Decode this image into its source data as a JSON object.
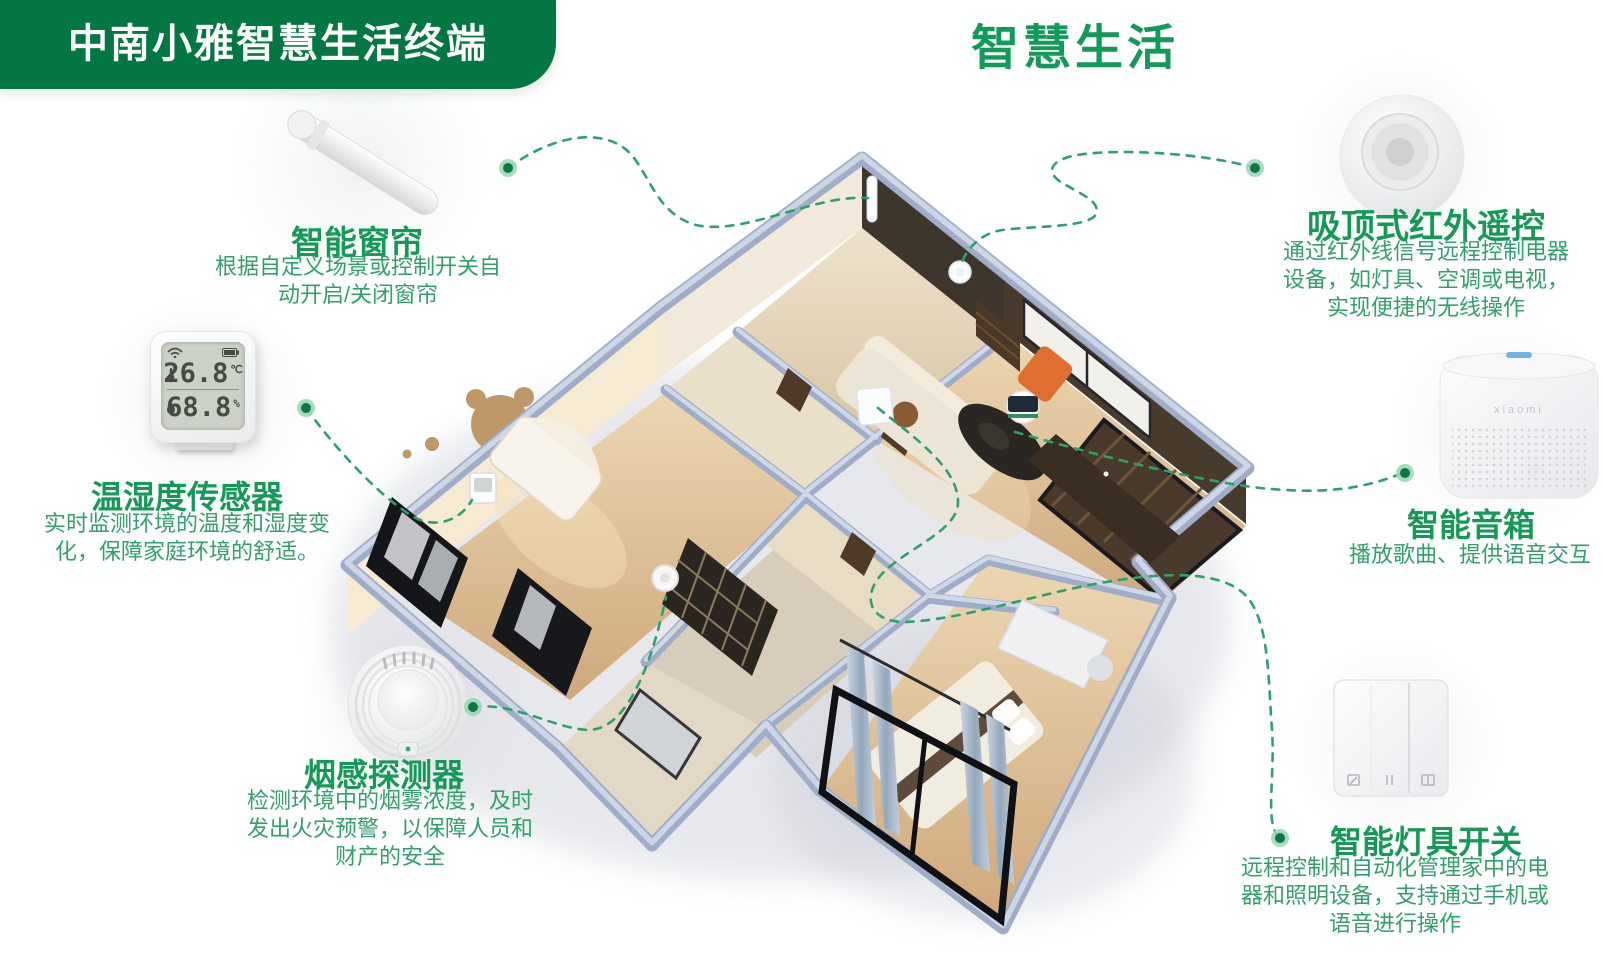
{
  "banner": {
    "label": "中南小雅智慧生活终端"
  },
  "header": {
    "title": "智慧生活"
  },
  "colors": {
    "brand_green": "#027741",
    "heading_green": "#149a57",
    "desc_green": "#2fa26a",
    "connector_green": "#2ba26b",
    "dot_green": "#0a7a41"
  },
  "devices": {
    "curtain": {
      "title": "智能窗帘",
      "desc": "根据自定义场景或控制开关自动开启/关闭窗帘"
    },
    "temp_sensor": {
      "title": "温湿度传感器",
      "desc": "实时监测环境的温度和湿度变化，保障家庭环境的舒适。",
      "lcd": {
        "temperature": "26.8",
        "temperature_unit": "℃",
        "humidity": "68.8",
        "humidity_unit": "%",
        "icons": {
          "signal": "wifi-icon",
          "power": "battery-icon",
          "temp": "thermometer-icon",
          "hum": "droplet-icon"
        }
      }
    },
    "smoke": {
      "title": "烟感探测器",
      "desc": "检测环境中的烟雾浓度，及时发出火灾预警，以保障人员和财产的安全"
    },
    "ir_remote": {
      "title": "吸顶式红外遥控",
      "desc": "通过红外线信号远程控制电器设备，如灯具、空调或电视，实现便捷的无线操作"
    },
    "speaker": {
      "title": "智能音箱",
      "desc": "播放歌曲、提供语音交互",
      "brand": "xiaomi"
    },
    "light_switch": {
      "title": "智能灯具开关",
      "desc": "远程控制和自动化管理家中的电器和照明设备，支持通过手机或语音进行操作"
    }
  }
}
